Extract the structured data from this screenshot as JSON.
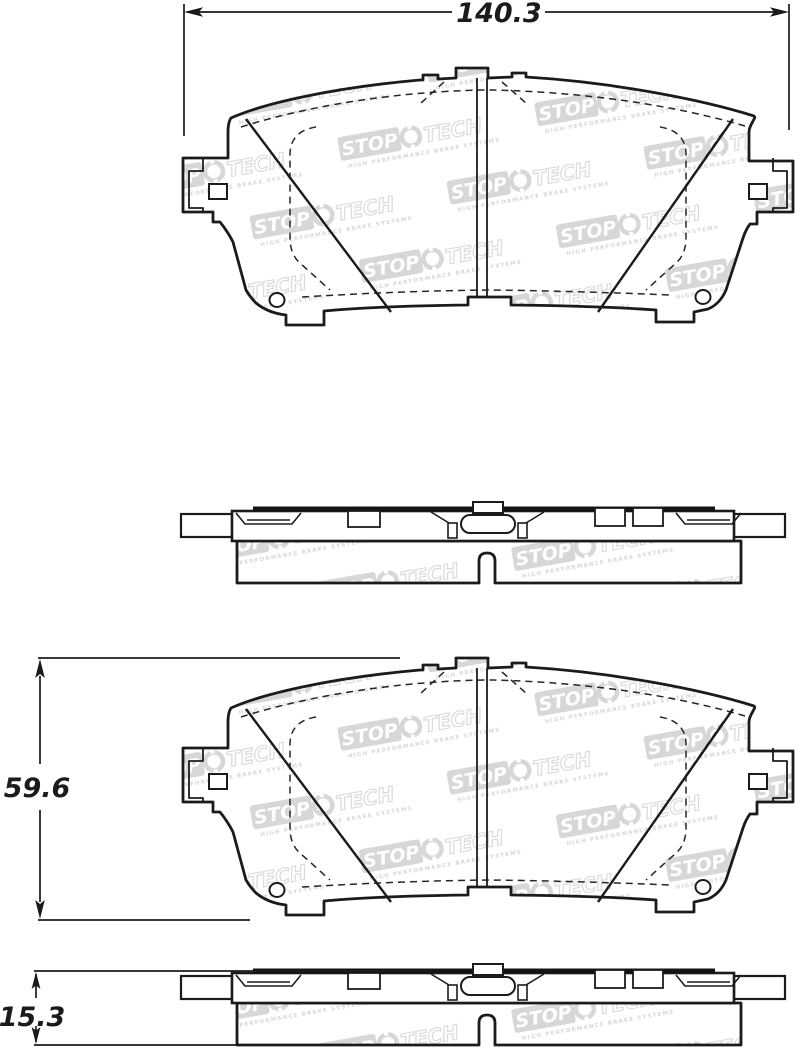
{
  "title": "Brake pad technical drawing",
  "dimensions": {
    "width": "140.3",
    "height": "59.6",
    "thickness": "15.3"
  },
  "watermark": {
    "stop": "STOP",
    "tech": "TECH",
    "tagline": "HIGH PERFORMANCE BRAKE SYSTEMS"
  },
  "colors": {
    "line": "#1b1b1b",
    "watermark": "#d7d7d7",
    "background": "#ffffff"
  }
}
